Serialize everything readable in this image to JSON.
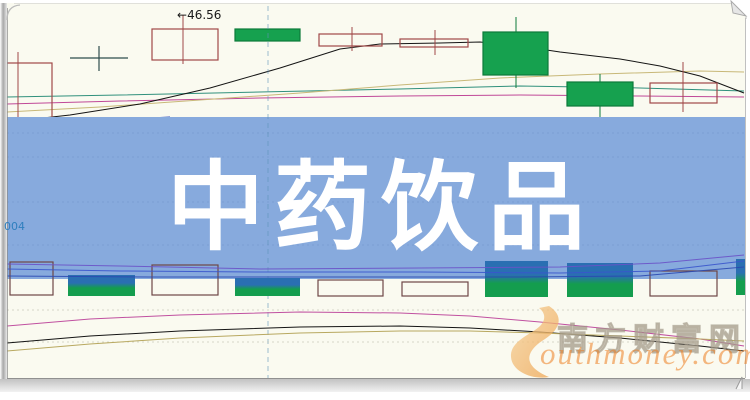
{
  "banner": {
    "title": "中药饮品",
    "bg_color": "#87aadd",
    "text_color": "#ffffff"
  },
  "labels": {
    "price_arrow": "←",
    "price": "46.56",
    "code": "004"
  },
  "watermark": {
    "cn": "南方财富网",
    "en": "outhmoney.com",
    "swoosh_color_light": "#f6d29a",
    "swoosh_color_dark": "#eda04a"
  },
  "colors": {
    "page_bg": "#fafaf0",
    "hollow_candle": "#a04848",
    "green_candle_fill": "#16a14f",
    "green_candle_stroke": "#0c7a3a",
    "volume_green_top": "#2a6fb2",
    "volume_green_bottom": "#149d4e",
    "doji": "#2e4d4d",
    "cursor_dash": "#5f93b8",
    "frame_gray": "#a8a8a8"
  },
  "chart_data": {
    "type": "candlestick",
    "note": "Stock K-line chart (price pane + volume pane + oscillator pane) mostly hidden by a promo banner. The only visible numeric label is 46.56; remaining values are encoded as screen-pixel geometry.",
    "visible_price_label": 46.56,
    "price_label_anchor": {
      "x": 183,
      "wick_top_y": 28,
      "label_y": 15
    },
    "cursor_line_x": 268,
    "banner_overlay": {
      "x1": 7,
      "x2": 745,
      "y1": 117,
      "y2": 279,
      "grid_ys": [
        133,
        157,
        202,
        245
      ]
    },
    "price_pane": {
      "candles": [
        {
          "type": "hollow",
          "x": 6,
          "w": 46,
          "bodyTop": 63,
          "bodyBot": 128,
          "wickX": 18,
          "wickTop": 52,
          "wickBot": 133
        },
        {
          "type": "doji",
          "x": 70,
          "w": 58,
          "axisY": 58,
          "wickX": 99,
          "wickTop": 46,
          "wickBot": 71
        },
        {
          "type": "hollow",
          "x": 152,
          "w": 66,
          "bodyTop": 29,
          "bodyBot": 60,
          "wickX": 183,
          "wickTop": 17,
          "wickBot": 64
        },
        {
          "type": "green",
          "x": 235,
          "w": 65,
          "bodyTop": 29,
          "bodyBot": 41,
          "wickX": 268,
          "wickTop": 29,
          "wickBot": 41
        },
        {
          "type": "hollow",
          "x": 319,
          "w": 63,
          "bodyTop": 34,
          "bodyBot": 46,
          "wickX": 352,
          "wickTop": 27,
          "wickBot": 51
        },
        {
          "type": "hollow",
          "x": 400,
          "w": 68,
          "bodyTop": 39,
          "bodyBot": 47,
          "wickX": 435,
          "wickTop": 30,
          "wickBot": 55
        },
        {
          "type": "green",
          "x": 483,
          "w": 65,
          "bodyTop": 32,
          "bodyBot": 75,
          "wickX": 516,
          "wickTop": 17,
          "wickBot": 88
        },
        {
          "type": "green",
          "x": 567,
          "w": 66,
          "bodyTop": 82,
          "bodyBot": 106,
          "wickX": 600,
          "wickTop": 74,
          "wickBot": 117
        },
        {
          "type": "hollow",
          "x": 650,
          "w": 67,
          "bodyTop": 83,
          "bodyBot": 103,
          "wickX": 683,
          "wickTop": 62,
          "wickBot": 112
        }
      ],
      "ma_lines": [
        {
          "name": "ma-blue",
          "color": "#2040c0",
          "points": [
            [
              7,
              127
            ],
            [
              60,
              124
            ],
            [
              110,
              121
            ],
            [
              150,
              118
            ],
            [
              170,
              117
            ]
          ]
        },
        {
          "name": "ma-teal",
          "color": "#30907c",
          "points": [
            [
              7,
              97
            ],
            [
              120,
              95
            ],
            [
              260,
              92
            ],
            [
              400,
              89
            ],
            [
              520,
              86
            ],
            [
              640,
              88
            ],
            [
              744,
              91
            ]
          ]
        },
        {
          "name": "ma-magenta",
          "color": "#c04898",
          "points": [
            [
              7,
              104
            ],
            [
              120,
              101
            ],
            [
              260,
              98
            ],
            [
              400,
              96
            ],
            [
              520,
              95
            ],
            [
              640,
              96
            ],
            [
              744,
              97
            ]
          ]
        },
        {
          "name": "ma-tan",
          "color": "#c8b878",
          "points": [
            [
              7,
              112
            ],
            [
              100,
              107
            ],
            [
              200,
              100
            ],
            [
              300,
              93
            ],
            [
              400,
              85
            ],
            [
              500,
              78
            ],
            [
              600,
              74
            ],
            [
              700,
              71
            ],
            [
              744,
              72
            ]
          ]
        },
        {
          "name": "ma-black",
          "color": "#141414",
          "points": [
            [
              7,
              122
            ],
            [
              70,
              115
            ],
            [
              140,
              104
            ],
            [
              210,
              88
            ],
            [
              280,
              68
            ],
            [
              340,
              49
            ],
            [
              380,
              44
            ],
            [
              440,
              43
            ],
            [
              480,
              42
            ],
            [
              520,
              46
            ],
            [
              560,
              52
            ],
            [
              620,
              59
            ],
            [
              660,
              66
            ],
            [
              700,
              76
            ],
            [
              744,
              93
            ]
          ]
        }
      ]
    },
    "volume_pane": {
      "baseline_y": 296,
      "bars": [
        {
          "type": "hollow",
          "x": 10,
          "w": 43,
          "top": 262,
          "bot": 295
        },
        {
          "type": "green",
          "x": 68,
          "w": 67,
          "top": 275,
          "bot": 296
        },
        {
          "type": "hollow",
          "x": 152,
          "w": 66,
          "top": 265,
          "bot": 295
        },
        {
          "type": "green",
          "x": 235,
          "w": 65,
          "top": 278,
          "bot": 296
        },
        {
          "type": "hollow",
          "x": 318,
          "w": 65,
          "top": 280,
          "bot": 296
        },
        {
          "type": "hollow",
          "x": 402,
          "w": 66,
          "top": 282,
          "bot": 296
        },
        {
          "type": "green",
          "x": 485,
          "w": 63,
          "top": 261,
          "bot": 297
        },
        {
          "type": "green",
          "x": 567,
          "w": 66,
          "top": 263,
          "bot": 297
        },
        {
          "type": "hollow",
          "x": 650,
          "w": 67,
          "top": 271,
          "bot": 296
        },
        {
          "type": "green",
          "x": 736,
          "w": 9,
          "top": 259,
          "bot": 295
        }
      ],
      "ma_lines": [
        {
          "name": "vol-ma-purple",
          "color": "#6a52c8",
          "points": [
            [
              7,
              264
            ],
            [
              120,
              266
            ],
            [
              260,
              269
            ],
            [
              420,
              268
            ],
            [
              560,
              267
            ],
            [
              660,
              263
            ],
            [
              744,
              255
            ]
          ]
        },
        {
          "name": "vol-ma-blue",
          "color": "#3a55cc",
          "points": [
            [
              7,
              269
            ],
            [
              120,
              271
            ],
            [
              260,
              272
            ],
            [
              420,
              272
            ],
            [
              560,
              273
            ],
            [
              660,
              271
            ],
            [
              744,
              261
            ]
          ]
        },
        {
          "name": "vol-ma-navy",
          "color": "#2a48b0",
          "points": [
            [
              7,
              276
            ],
            [
              150,
              277
            ],
            [
              350,
              277
            ],
            [
              520,
              277
            ],
            [
              640,
              276
            ],
            [
              744,
              267
            ]
          ]
        }
      ]
    },
    "indicator_pane": {
      "gridlines_y": [
        310,
        342
      ],
      "curves": [
        {
          "name": "osc-magenta",
          "color": "#c050a0",
          "points": [
            [
              7,
              326
            ],
            [
              90,
              319
            ],
            [
              180,
              315
            ],
            [
              300,
              312
            ],
            [
              400,
              313
            ],
            [
              470,
              316
            ],
            [
              540,
              322
            ],
            [
              620,
              330
            ],
            [
              700,
              339
            ],
            [
              744,
              346
            ]
          ]
        },
        {
          "name": "osc-black",
          "color": "#141414",
          "points": [
            [
              7,
              343
            ],
            [
              90,
              336
            ],
            [
              180,
              331
            ],
            [
              300,
              327
            ],
            [
              400,
              326
            ],
            [
              470,
              328
            ],
            [
              540,
              332
            ],
            [
              620,
              338
            ],
            [
              700,
              346
            ],
            [
              744,
              351
            ]
          ]
        },
        {
          "name": "osc-tan",
          "color": "#b8a860",
          "points": [
            [
              7,
              351
            ],
            [
              90,
              344
            ],
            [
              180,
              338
            ],
            [
              300,
              333
            ],
            [
              400,
              331
            ],
            [
              470,
              331
            ],
            [
              540,
              333
            ],
            [
              620,
              336
            ],
            [
              700,
              339
            ],
            [
              744,
              341
            ]
          ]
        }
      ]
    }
  }
}
